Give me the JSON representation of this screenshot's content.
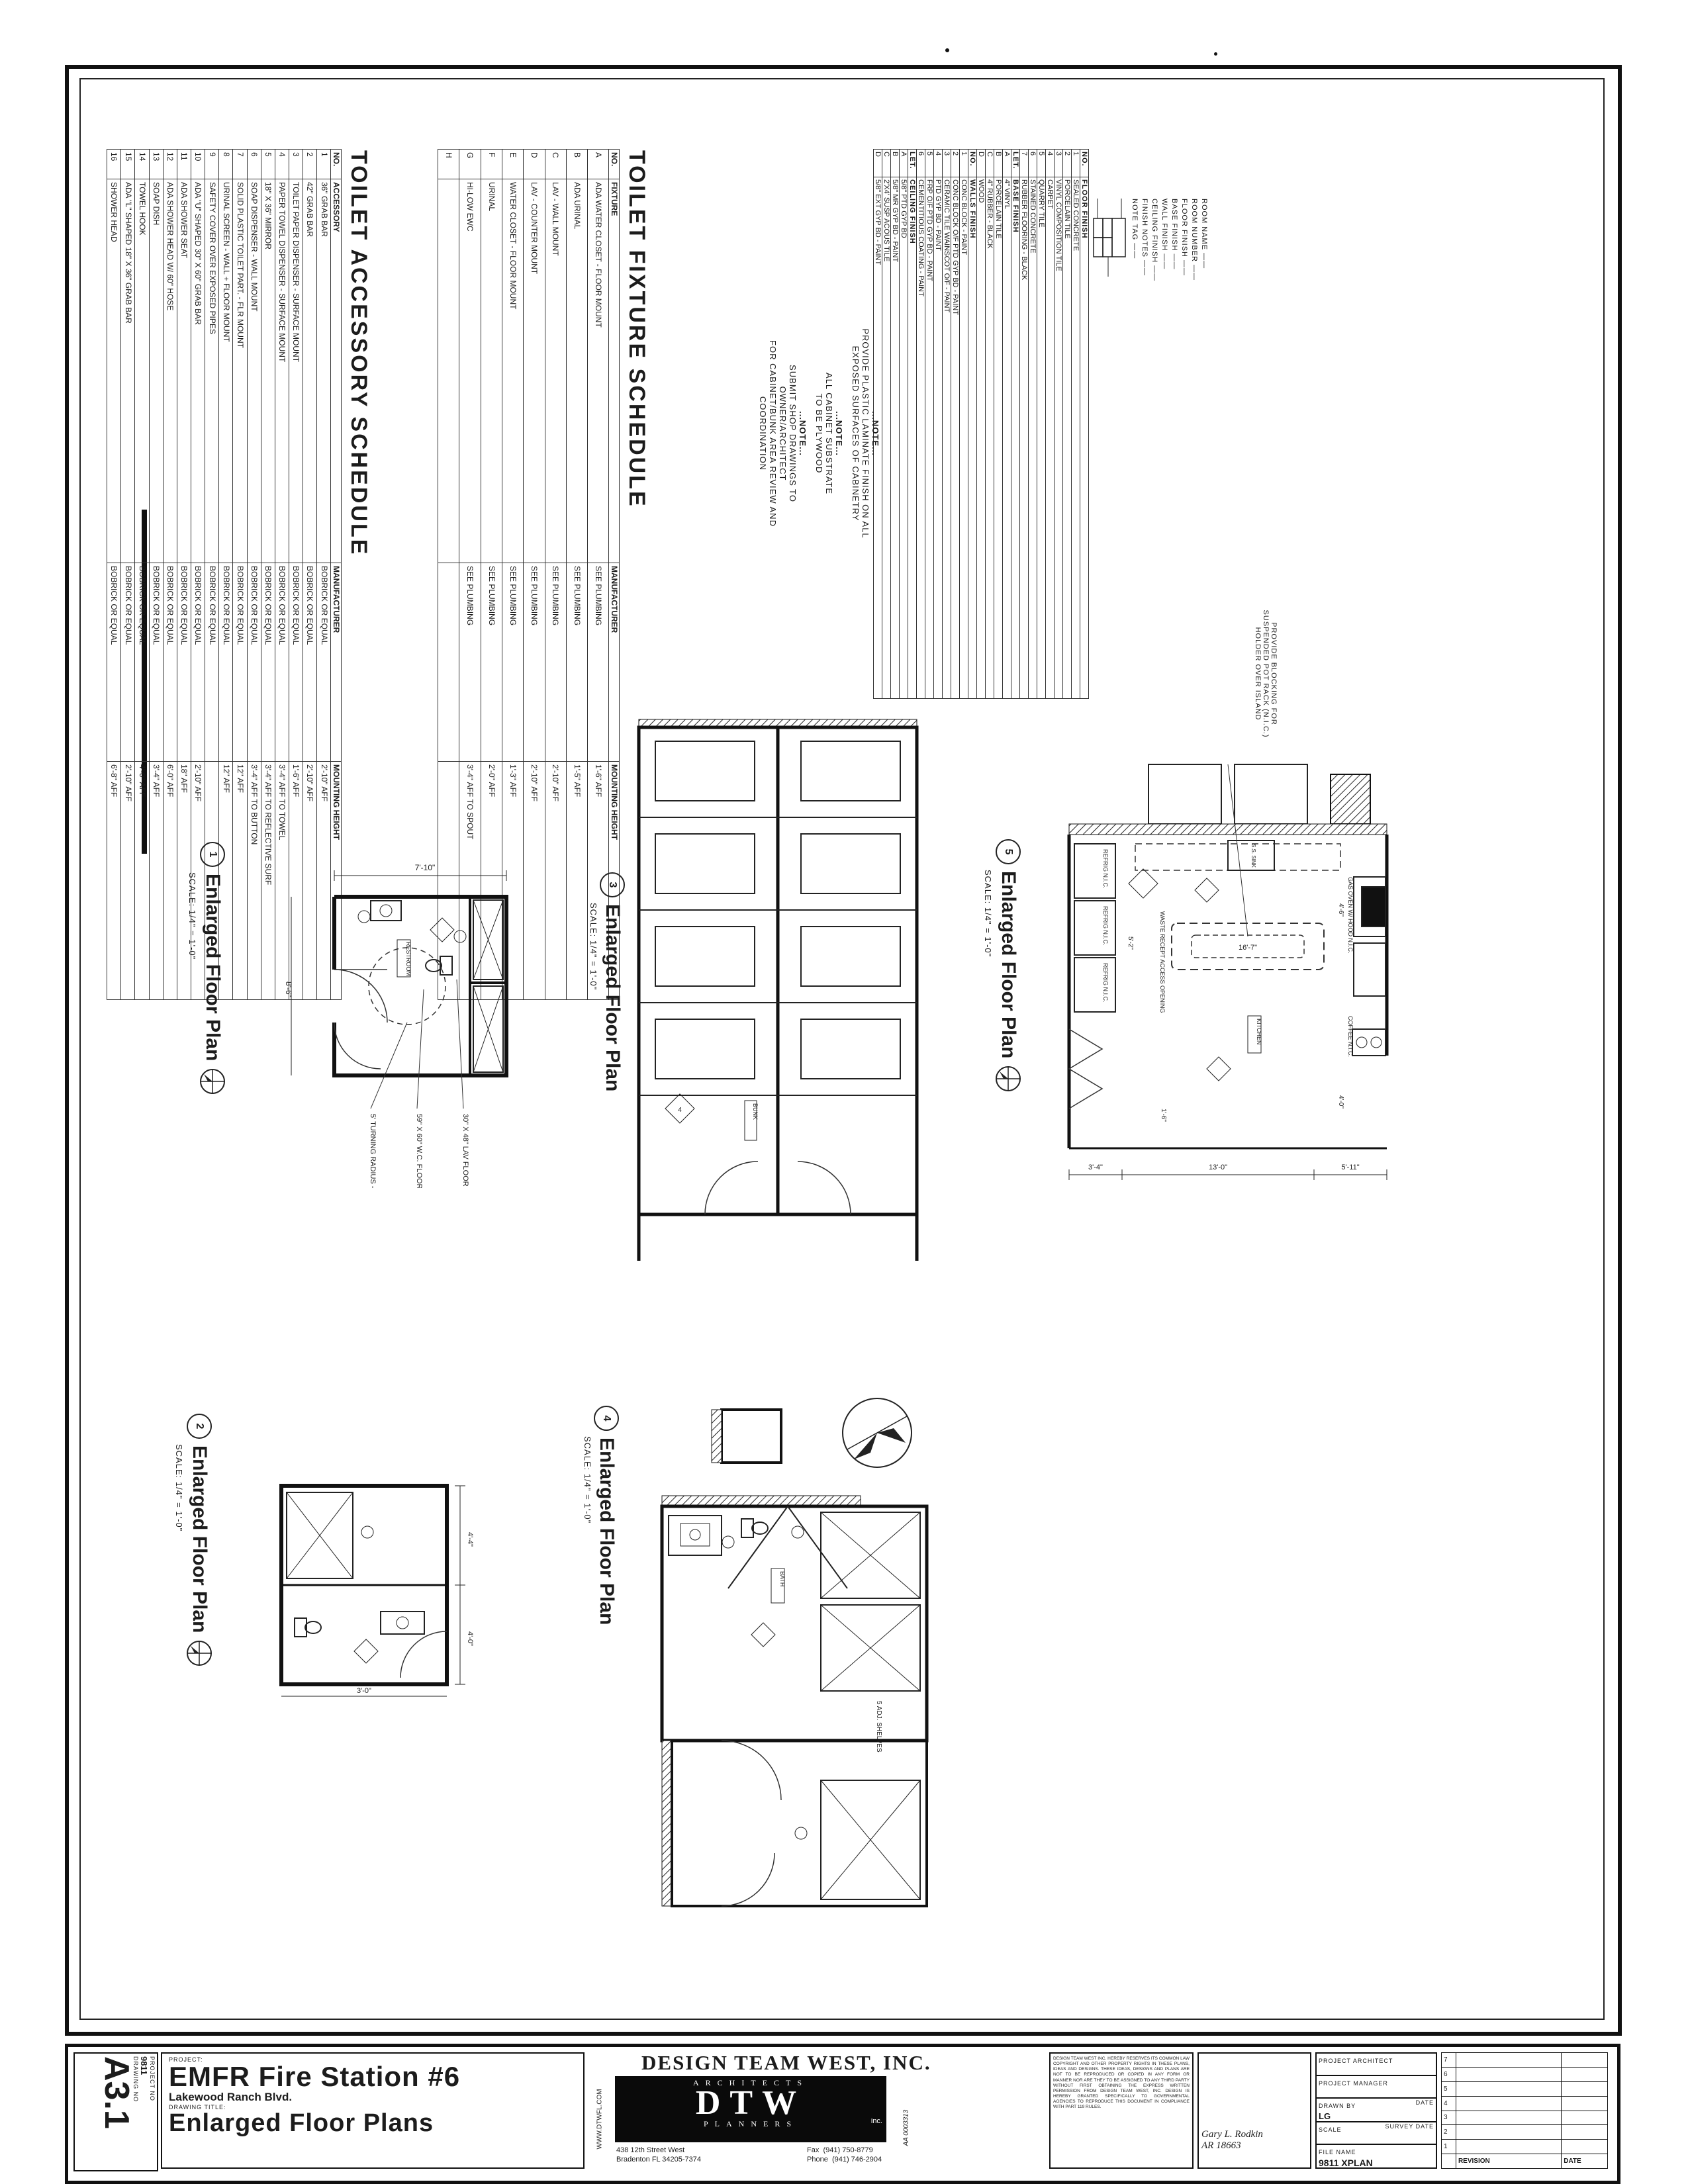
{
  "sheet": {
    "drawing_no_label": "DRAWING NO",
    "drawing_no": "A3.1",
    "project_no_label": "PROJECT NO",
    "project_no": "9811",
    "project_label": "PROJECT:",
    "project_name": "EMFR Fire Station #6",
    "project_address": "Lakewood Ranch Blvd.",
    "drawing_title_label": "DRAWING TITLE:",
    "drawing_title": "Enlarged Floor Plans"
  },
  "firm": {
    "name": "DESIGN TEAM WEST, INC.",
    "logo_top": "ARCHITECTS",
    "logo_main": "DTW",
    "logo_inc": "inc.",
    "logo_bottom": "PLANNERS",
    "website": "WWW.DTWFL.COM",
    "license": "AA 0003313",
    "address1": "438 12th Street West",
    "address2": "Bradenton FL 34205-7374",
    "fax_label": "Fax",
    "fax": "(941) 750-8779",
    "phone_label": "Phone",
    "phone": "(941) 746-2904",
    "disclaimer": "DESIGN TEAM WEST INC. HEREBY RESERVES ITS COMMON LAW COPYRIGHT AND OTHER PROPERTY RIGHTS IN THESE PLANS, IDEAS AND DESIGNS. THESE IDEAS, DESIGNS AND PLANS ARE NOT TO BE REPRODUCED OR COPIED IN ANY FORM OR MANNER NOR ARE THEY TO BE ASSIGNED TO ANY THIRD PARTY WITHOUT FIRST OBTAINING THE EXPRESS WRITTEN PERMISSION FROM DESIGN TEAM WEST, INC. DESIGN IS HEREBY GRANTED SPECIFICALLY TO GOVERNMENTAL AGENCIES TO REPRODUCE THIS DOCUMENT IN COMPLIANCE WITH PART 119 RULES."
  },
  "seal": {
    "architect": "Gary L. Rodkin",
    "license": "AR 18663"
  },
  "fields": {
    "project_architect_label": "PROJECT ARCHITECT",
    "project_manager_label": "PROJECT MANAGER",
    "drawn_by_label": "DRAWN BY",
    "date_label": "DATE",
    "drawn_by": "LG",
    "scale_label": "SCALE",
    "survey_date_label": "SURVEY DATE",
    "file_name_label": "FILE NAME",
    "file_name": "9811 XPLAN"
  },
  "revisions": {
    "numbers": [
      "7",
      "6",
      "5",
      "4",
      "3",
      "2",
      "1"
    ],
    "revision_label": "REVISION",
    "date_label": "DATE"
  },
  "schedules": {
    "accessory": {
      "title": "TOILET ACCESSORY SCHEDULE",
      "headers": [
        "NO.",
        "ACCESSORY",
        "MANUFACTURER",
        "MOUNTING HEIGHT"
      ],
      "rows": [
        [
          "1",
          "36\" GRAB BAR",
          "BOBRICK OR EQUAL",
          "2'-10\" AFF"
        ],
        [
          "2",
          "42\" GRAB BAR",
          "BOBRICK OR EQUAL",
          "2'-10\" AFF"
        ],
        [
          "3",
          "TOILET PAPER DISPENSER - SURFACE MOUNT",
          "BOBRICK OR EQUAL",
          "1'-6\" AFF"
        ],
        [
          "4",
          "PAPER TOWEL DISPENSER - SURFACE MOUNT",
          "BOBRICK OR EQUAL",
          "3'-4\" AFF TO TOWEL"
        ],
        [
          "5",
          "18\" X 36\" MIRROR",
          "BOBRICK OR EQUAL",
          "3'-4\" AFF TO REFLECTIVE SURF"
        ],
        [
          "6",
          "SOAP DISPENSER - WALL MOUNT",
          "BOBRICK OR EQUAL",
          "3'-4\" AFF TO BUTTON"
        ],
        [
          "7",
          "SOLID PLASTIC TOILET PART. - FLR MOUNT",
          "BOBRICK OR EQUAL",
          "12\" AFF"
        ],
        [
          "8",
          "URINAL SCREEN - WALL + FLOOR MOUNT",
          "BOBRICK OR EQUAL",
          "12\" AFF"
        ],
        [
          "9",
          "SAFETY COVER OVER EXPOSED PIPES",
          "BOBRICK OR EQUAL",
          ""
        ],
        [
          "10",
          "ADA \"U\" SHAPED 30\" X 60\" GRAB BAR",
          "BOBRICK OR EQUAL",
          "2'-10\" AFF"
        ],
        [
          "11",
          "ADA SHOWER SEAT",
          "BOBRICK OR EQUAL",
          "18\" AFF"
        ],
        [
          "12",
          "ADA SHOWER HEAD W/ 60\" HOSE",
          "BOBRICK OR EQUAL",
          "6'-0\" AFF"
        ],
        [
          "13",
          "SOAP DISH",
          "BOBRICK OR EQUAL",
          "3'-4\" AFF"
        ],
        [
          "14",
          "TOWEL HOOK",
          "BOBRICK OR EQUAL",
          "4'-0\" AFF"
        ],
        [
          "15",
          "ADA \"L\" SHAPED 18\" X 36\" GRAB BAR",
          "BOBRICK OR EQUAL",
          "2'-10\" AFF"
        ],
        [
          "16",
          "SHOWER HEAD",
          "BOBRICK OR EQUAL",
          "6'-8\" AFF"
        ]
      ]
    },
    "fixture": {
      "title": "TOILET FIXTURE SCHEDULE",
      "headers": [
        "NO.",
        "FIXTURE",
        "MANUFACTURER",
        "MOUNTING HEIGHT"
      ],
      "rows": [
        [
          "A",
          "ADA WATER CLOSET - FLOOR MOUNT",
          "SEE PLUMBING",
          "1'-6\" AFF"
        ],
        [
          "B",
          "ADA URINAL",
          "SEE PLUMBING",
          "1'-5\" AFF"
        ],
        [
          "C",
          "LAV - WALL MOUNT",
          "SEE PLUMBING",
          "2'-10\" AFF"
        ],
        [
          "D",
          "LAV - COUNTER MOUNT",
          "SEE PLUMBING",
          "2'-10\" AFF"
        ],
        [
          "E",
          "WATER CLOSET - FLOOR MOUNT",
          "SEE PLUMBING",
          "1'-3\" AFF"
        ],
        [
          "F",
          "URINAL",
          "SEE PLUMBING",
          "2'-0\" AFF"
        ],
        [
          "G",
          "HI-LOW EWC",
          "SEE PLUMBING",
          "3'-4\" AFF TO SPOUT"
        ],
        [
          "H",
          "",
          "",
          ""
        ]
      ]
    },
    "finish": {
      "sections": [
        {
          "name": "FLOOR",
          "sub": "FINISH",
          "key_header": "NO.",
          "rows": [
            [
              "1",
              "SEALED CONCRETE"
            ],
            [
              "2",
              "PORCELAIN TILE"
            ],
            [
              "3",
              "VINYL COMPOSITION TILE"
            ],
            [
              "4",
              "CARPET"
            ],
            [
              "5",
              "QUARRY TILE"
            ],
            [
              "6",
              "STAINED CONCRETE"
            ],
            [
              "7",
              "RUBBER FLOORING - BLACK"
            ]
          ]
        },
        {
          "name": "BASE",
          "sub": "FINISH",
          "key_header": "LET.",
          "rows": [
            [
              "A",
              "4\" VINYL"
            ],
            [
              "B",
              "PORCELAIN TILE"
            ],
            [
              "C",
              "4\" RUBBER - BLACK"
            ],
            [
              "D",
              "WOOD"
            ]
          ]
        },
        {
          "name": "WALLS",
          "sub": "FINISH",
          "key_header": "NO.",
          "rows": [
            [
              "1",
              "CONC BLOCK - PAINT"
            ],
            [
              "2",
              "CONC BLOCK O/F PTD GYP BD - PAINT"
            ],
            [
              "3",
              "CERAMIC TILE WAINSCOT O/F - PAINT"
            ],
            [
              "4",
              "PTD GYP BD - PAINT"
            ],
            [
              "5",
              "FRP O/F PTD GYP BD - PAINT"
            ],
            [
              "6",
              "CEMENTITIOUS COATING - PAINT"
            ]
          ]
        },
        {
          "name": "CEILING",
          "sub": "FINISH",
          "key_header": "LET.",
          "rows": [
            [
              "A",
              "5/8\" PTD GYP BD"
            ],
            [
              "B",
              "5/8\" MR GYP BD - PAINT"
            ],
            [
              "C",
              "2'X4' SUSP ACOUS TILE"
            ],
            [
              "D",
              "5/8\" EXT GYP BD - PAINT"
            ]
          ]
        }
      ],
      "legend": [
        "ROOM NAME",
        "ROOM NUMBER",
        "FLOOR FINISH",
        "BASE FINISH",
        "WALL FINISH",
        "CEILING FINISH",
        "FINISH NOTES",
        "NOTE TAG"
      ]
    }
  },
  "notes": [
    {
      "head": "...NOTE...",
      "body": "PROVIDE PLASTIC LAMINATE FINISH ON ALL\nEXPOSED SURFACES OF CABINETRY"
    },
    {
      "head": "...NOTE...",
      "body": "ALL CABINET SUBSTRATE\nTO BE PLYWOOD"
    },
    {
      "head": "...NOTE...",
      "body": "SUBMIT SHOP DRAWINGS TO\nOWNER/ARCHITECT\nFOR CABINET/BUNK AREA REVIEW AND\nCOORDINATION"
    }
  ],
  "plans": [
    {
      "number": "1",
      "title": "Enlarged Floor Plan",
      "scale": "SCALE: 1/4\" = 1'-0\"",
      "room": "RESTROOM",
      "dim_top": "7'-10\"",
      "dim_left": "8'-6\"",
      "note1": "5' TURNING RADIUS - TYP",
      "note2": "59\" X 60\" W.C. FLOOR CLEARANCE - TYP",
      "note3": "30\" X 48\" LAV FLOOR CLEARANCE - TYP"
    },
    {
      "number": "2",
      "title": "Enlarged Floor Plan",
      "scale": "SCALE: 1/4\" = 1'-0\"",
      "room": "RESTROOM",
      "dim1": "4'-4\"",
      "dim2": "4'-0\"",
      "dim3": "3'-0\""
    },
    {
      "number": "3",
      "title": "Enlarged Floor Plan",
      "scale": "SCALE: 1/4\" = 1'-0\"",
      "room": "BUNK",
      "wall_tag": "4"
    },
    {
      "number": "4",
      "title": "Enlarged Floor Plan",
      "scale": "SCALE: 1/4\" = 1'-0\"",
      "room": "BATH",
      "shelves_note": "5 ADJ. SHELVES"
    },
    {
      "number": "5",
      "title": "Enlarged Floor Plan",
      "scale": "SCALE: 1/4\" = 1'-0\"",
      "room": "KITCHEN",
      "refrig": "REFRIG N.I.C.",
      "waste": "WASTE RECEPT ACCESS OPENING",
      "ss_sink": "S.S. SINK",
      "gas_oven": "GAS OVEN W/ HOOD N.I.C.",
      "coffee": "COFFEE N.I.C.",
      "pot_rack_note": "PROVIDE BLOCKING FOR\nSUSPENDED POT RACK (N.I.C.)\nHOLDER OVER ISLAND",
      "dim_island": "16'-7\"",
      "dim_a": "5'-2\"",
      "dim_b": "4'-6\"",
      "dim_c": "4'-0\"",
      "dim_d": "1'-6\"",
      "dim_e": "3'-4\"",
      "dim_f": "13'-0\"",
      "dim_g": "5'-11\""
    }
  ]
}
